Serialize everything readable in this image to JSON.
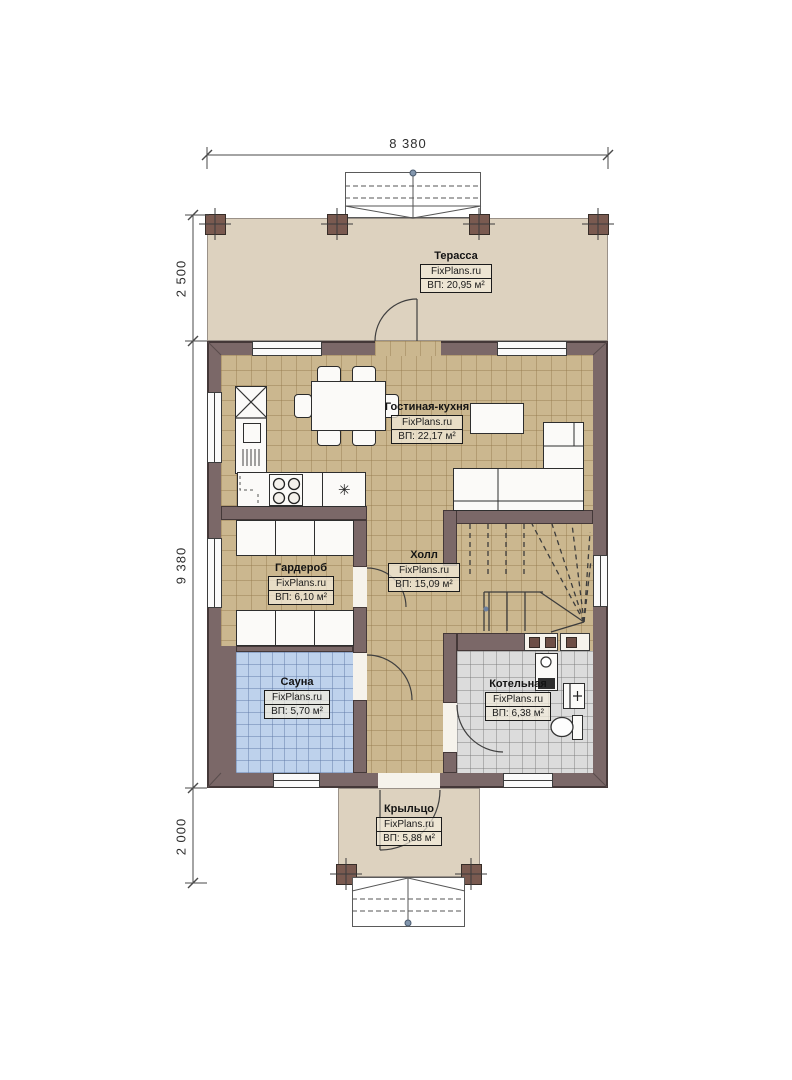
{
  "plan": {
    "dimensions": {
      "width_top": "8 380",
      "terrace_depth": "2 500",
      "house_depth": "9 380",
      "porch_depth": "2 000"
    },
    "watermark": "FixPlans.ru",
    "rooms": {
      "terrace": {
        "name": "Терасса",
        "area": "ВП: 20,95 м²"
      },
      "living_kitchen": {
        "name": "Гостиная-кухня",
        "area": "ВП: 22,17 м²"
      },
      "hall": {
        "name": "Холл",
        "area": "ВП: 15,09 м²"
      },
      "wardrobe": {
        "name": "Гардероб",
        "area": "ВП: 6,10 м²"
      },
      "sauna": {
        "name": "Сауна",
        "area": "ВП: 5,70 м²"
      },
      "boiler": {
        "name": "Котельная",
        "area": "ВП: 6,38 м²"
      },
      "porch": {
        "name": "Крыльцо",
        "area": "ВП: 5,88 м²"
      }
    },
    "icons": {
      "sink": "✳"
    },
    "colors": {
      "wall": "#7b6868",
      "terrace_floor": "#ddd2bf",
      "living_floor": "#cbb78f",
      "sauna_floor": "#bed2ec",
      "boiler_floor": "#dcdcdc",
      "post": "#7a5a50"
    }
  }
}
